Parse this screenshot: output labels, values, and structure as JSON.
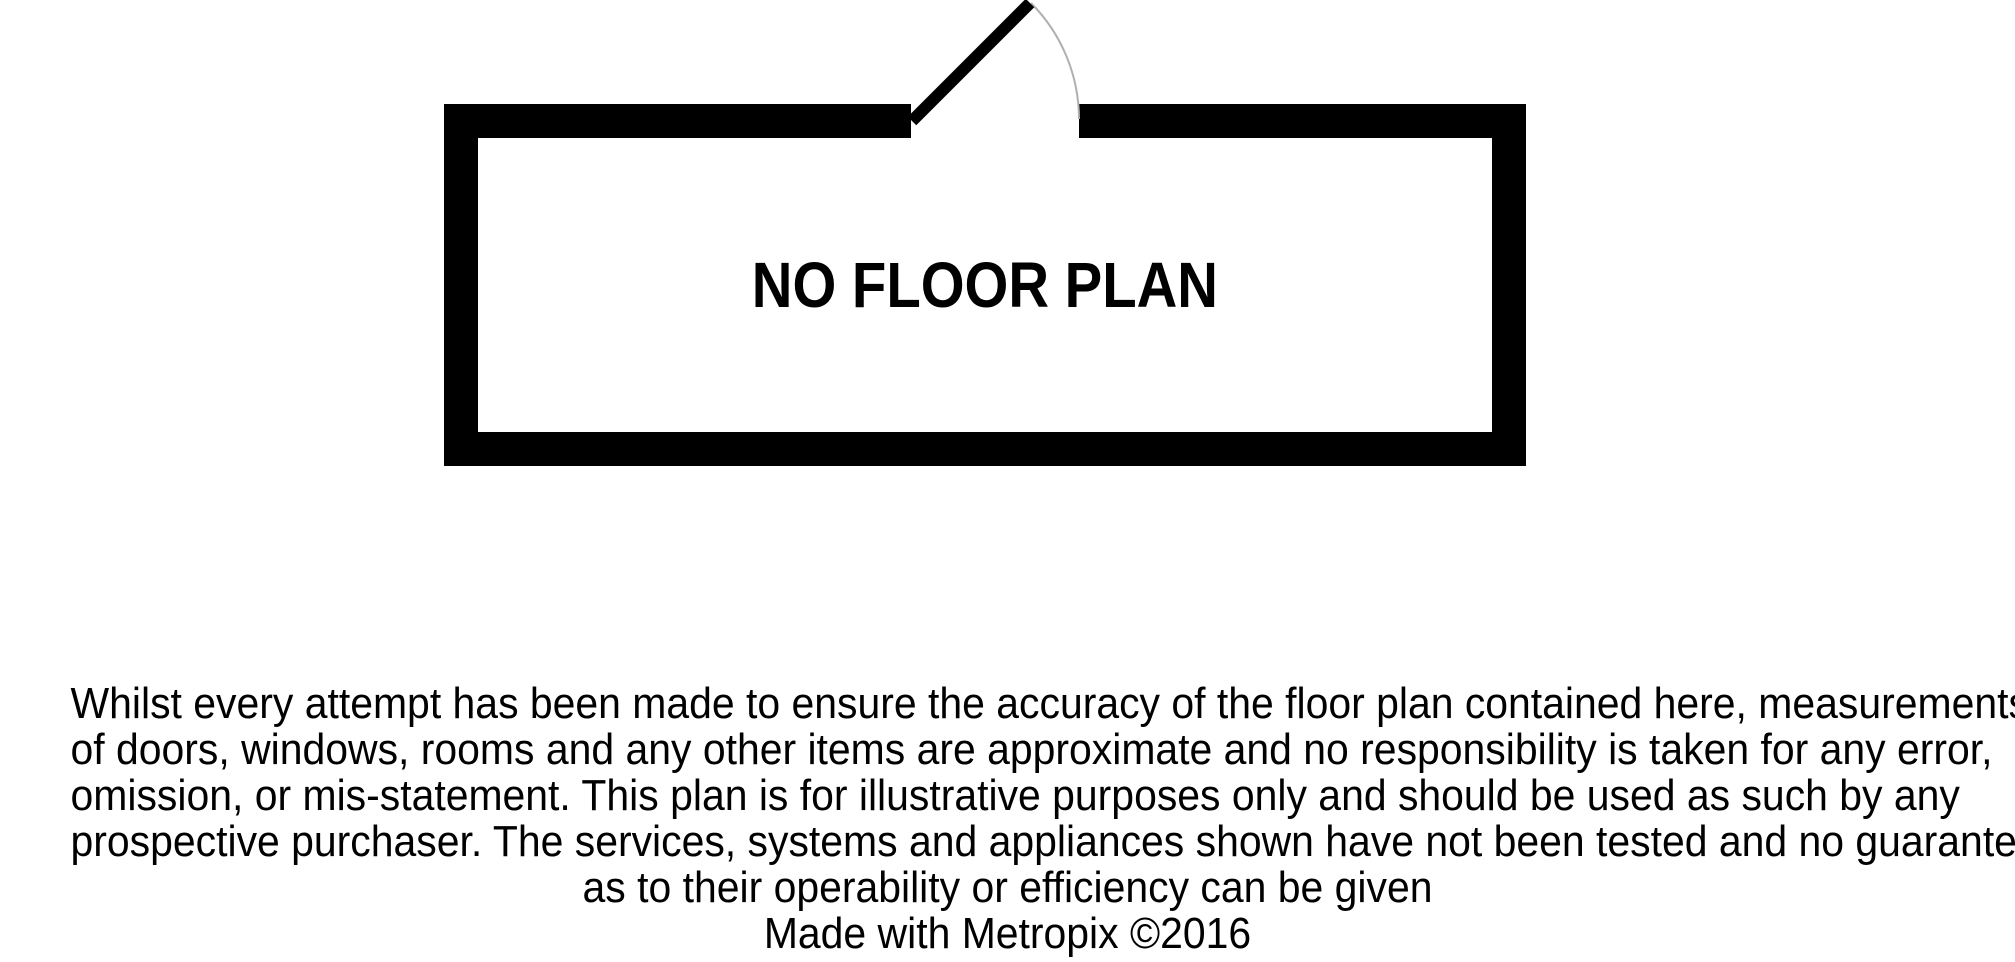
{
  "placeholder": {
    "title": "NO FLOOR PLAN"
  },
  "disclaimer": {
    "lines": [
      "Whilst every attempt has been made to ensure the accuracy of the floor plan contained here, measurements",
      "of doors, windows, rooms and any other items are approximate and no responsibility is taken for any error,",
      "omission, or mis-statement. This plan is for illustrative purposes only and should be used as such by any",
      "prospective purchaser. The services, systems and appliances shown have not been tested and no guarantee",
      "as to their operability or efficiency can be given"
    ],
    "credit": "Made with Metropix ©2016"
  },
  "colors": {
    "wall": "#000000",
    "text": "#000000",
    "door_arc": "#b0b0b0",
    "background": "#ffffff"
  }
}
